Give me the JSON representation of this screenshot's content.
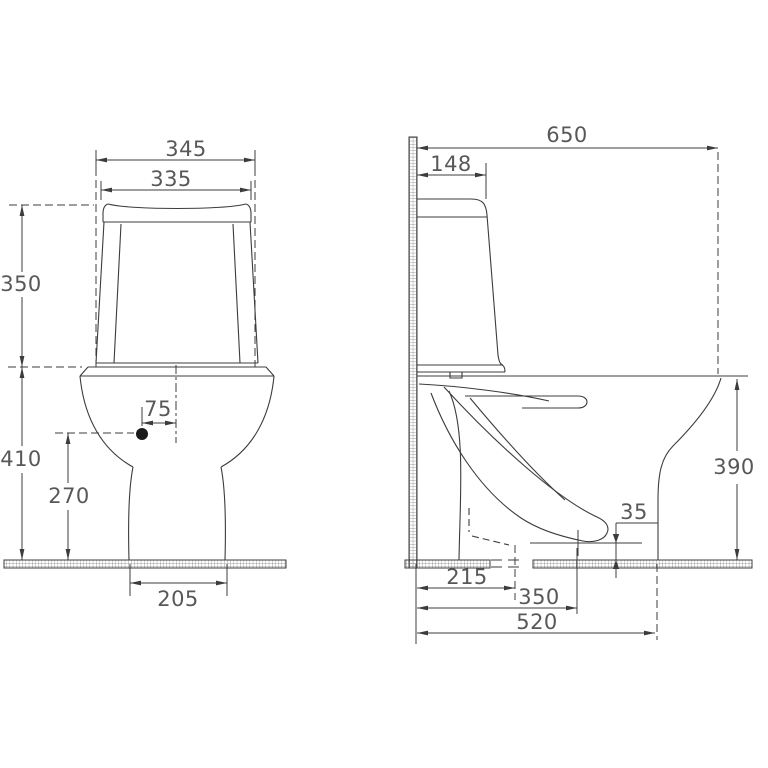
{
  "drawing": {
    "background": "#ffffff",
    "line_color": "#3c3c3c",
    "text_color": "#585858",
    "front_view": {
      "tank_bottom_width": "345",
      "lid_width": "335",
      "tank_height": "350",
      "bowl_height": "410",
      "hole_height": "270",
      "hole_offset": "75",
      "base_width": "205"
    },
    "side_view": {
      "total_depth": "650",
      "tank_top_depth": "148",
      "rim_height": "390",
      "outlet_to_floor": "35",
      "wall_to_drain": "215",
      "wall_to_outlet_center": "350",
      "wall_to_front_foot": "520"
    }
  }
}
